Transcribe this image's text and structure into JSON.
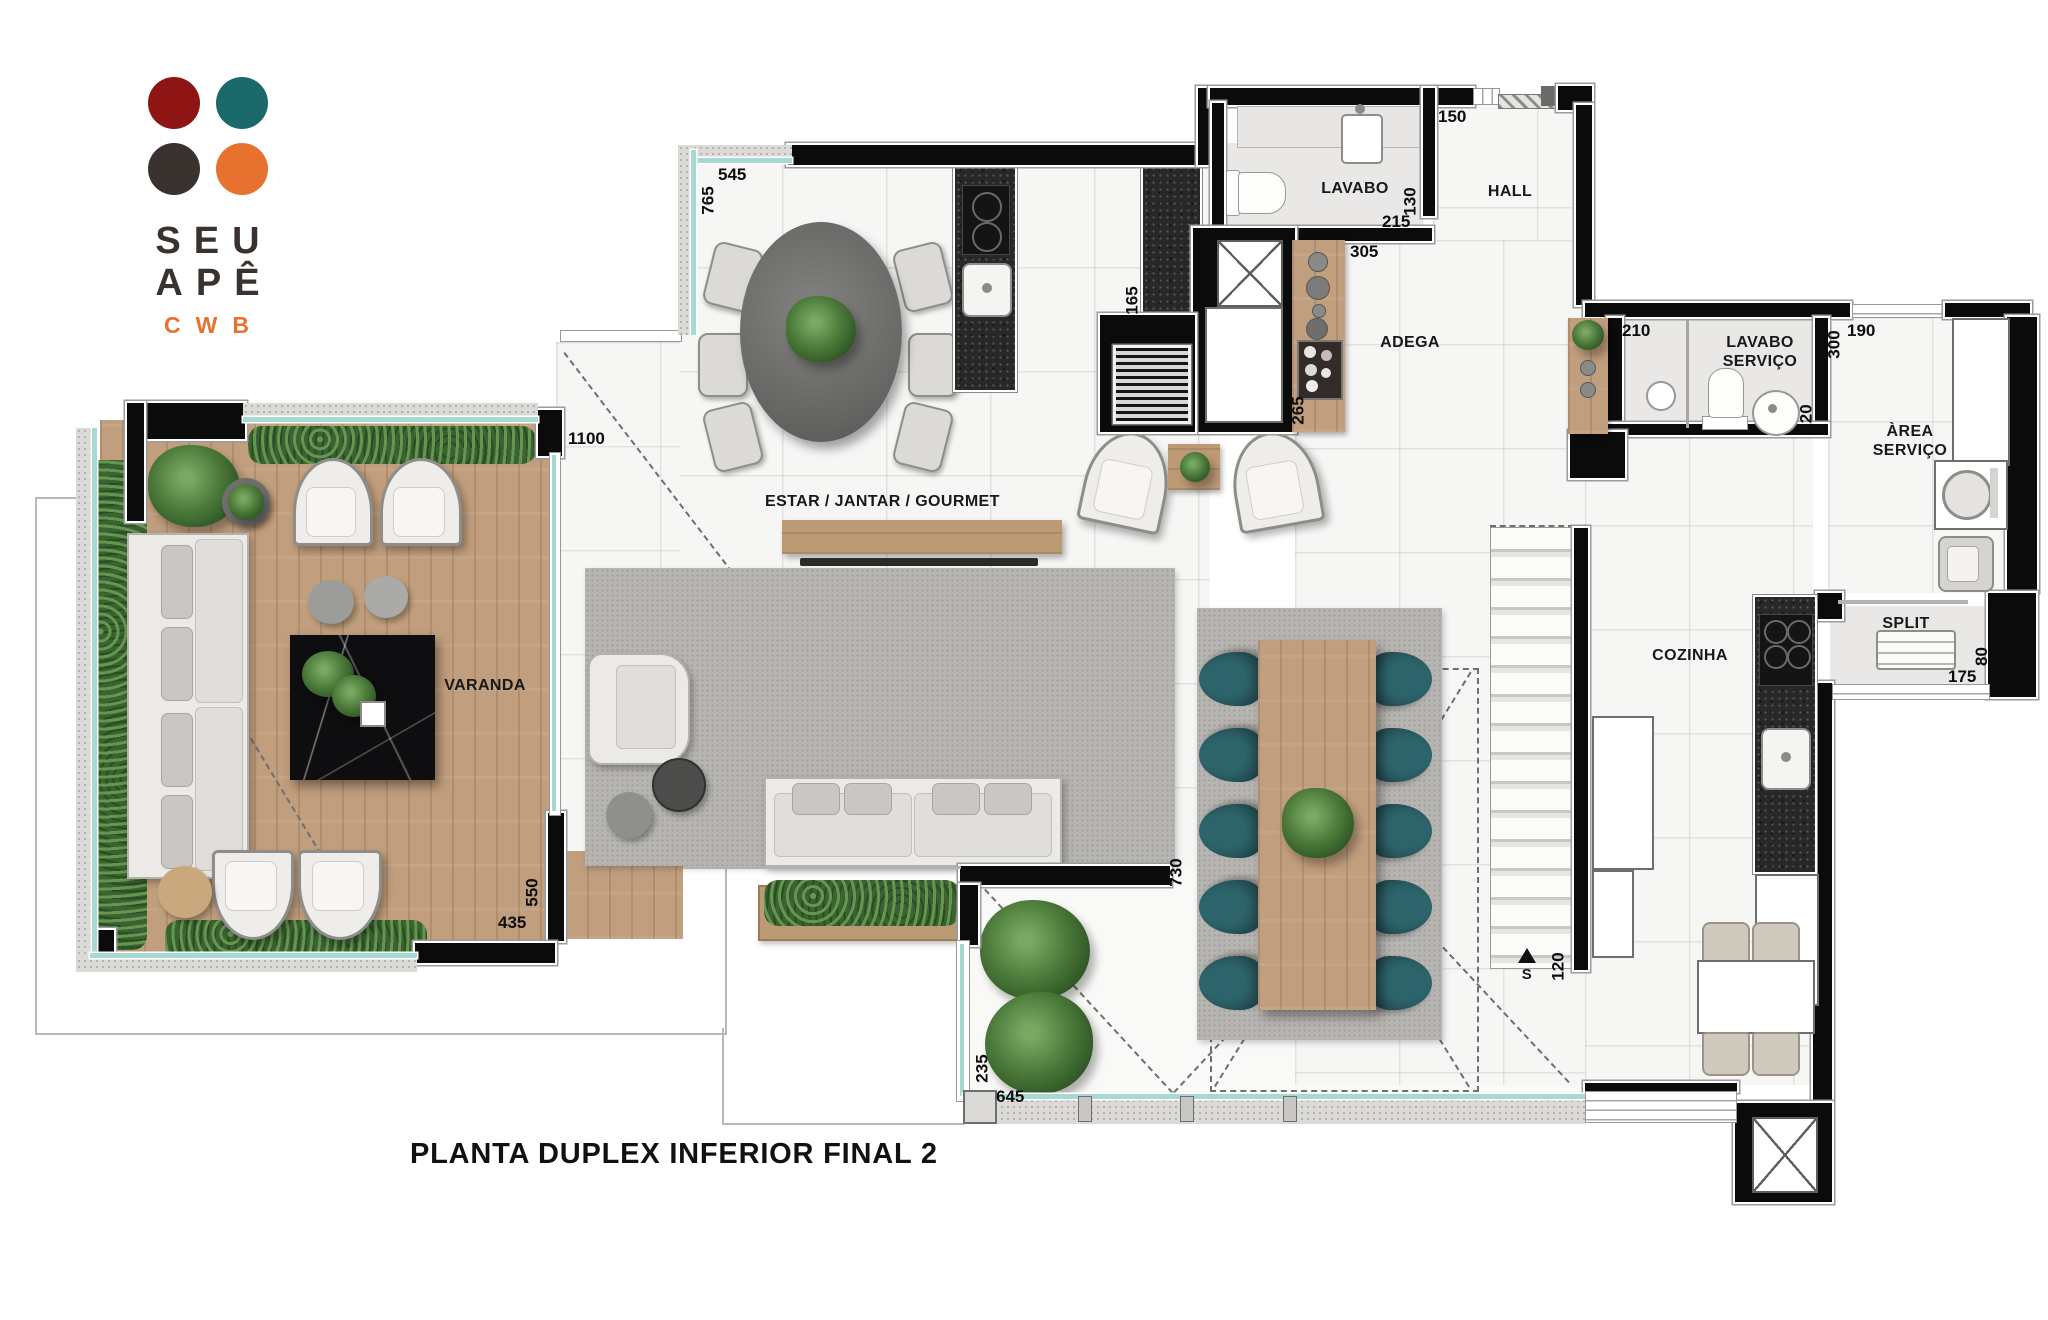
{
  "brand": {
    "line1": "SEU",
    "line2": "APÊ",
    "line3": "CWB",
    "colors": {
      "circle_tl": "#8e1513",
      "circle_tr": "#1a6a6c",
      "circle_bl": "#39322e",
      "circle_br": "#e7722f",
      "accent": "#e7722f",
      "text": "#39322e"
    }
  },
  "title": "PLANTA DUPLEX INFERIOR FINAL 2",
  "rooms": {
    "varanda": "VARANDA",
    "estar": "ESTAR / JANTAR / GOURMET",
    "lavabo": "LAVABO",
    "hall": "HALL",
    "adega": "ADEGA",
    "lavabo_servico": "LAVABO SERVIÇO",
    "area_servico": "ÀREA SERVIÇO",
    "cozinha": "COZINHA",
    "split": "SPLIT"
  },
  "dims": {
    "varanda_top": "545",
    "varanda_top_v": "765",
    "estar_opening": "1100",
    "varanda_side_v": "550",
    "varanda_bottom": "435",
    "lavabo_top": "150",
    "lavabo_h_v": "130",
    "lavabo_w": "215",
    "adega_top": "305",
    "gourmet_v": "165",
    "adega_v": "265",
    "lav_serv_top": "210",
    "area_serv_top": "190",
    "area_serv_v": "300",
    "lav_serv_v": "120",
    "terrace_wall_v": "730",
    "stair_v": "120",
    "terrace_side_v": "235",
    "terrace_bottom": "645",
    "split_w": "175",
    "split_h_v": "80"
  },
  "stair_marker": "S"
}
